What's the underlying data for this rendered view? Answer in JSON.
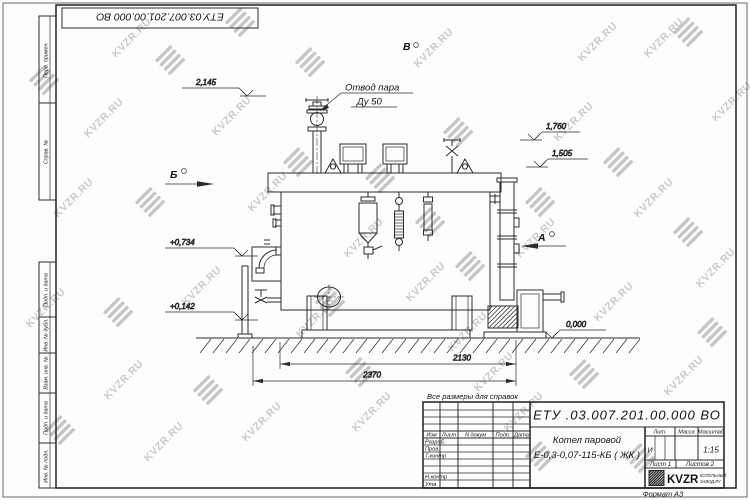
{
  "stamp_top": {
    "doc_number": "ЕТУ.03.007.201.00.000  ВО"
  },
  "watermark": {
    "label": "KVZR.RU"
  },
  "frame_columns": {
    "perv_primen": "Перв. примен.",
    "sprav_no": "Справ. №",
    "podp_data_1": "Подп. и дата",
    "inv_no_dubl": "Инв. № дубл.",
    "vzam_inv_no": "Взам. инв. №",
    "podp_data_2": "Подп. и дата",
    "inv_no_podl": "Инв. № подл."
  },
  "annotations": {
    "steam_line1": "Отвод пара",
    "steam_line2": "Ду 50",
    "note": "Все размеры для справок",
    "view_b": "Б",
    "view_v": "В",
    "view_a": "А"
  },
  "elevations": {
    "top_left": "2,145",
    "right_1": "1,760",
    "right_2": "1,505",
    "mid_left": "+0,734",
    "low_left": "+0,142",
    "ground": "0,000"
  },
  "dimensions": {
    "inner": "2130",
    "outer": "2370"
  },
  "title_block": {
    "doc_number": "ЕТУ .03.007.201.00.000  ВО",
    "product_line1": "Котел паровой",
    "product_line2": "Е-0,3-0,07-115-КБ ( ЖК )",
    "headers": {
      "izm": "Изм",
      "list": "Лист",
      "n_dokum": "N докум",
      "podp": "Подп.",
      "data": "Дата",
      "lit": "Лит.",
      "massa": "Масса",
      "masshtab": "Масштаб"
    },
    "rows": {
      "razrab": "Разраб.",
      "prov": "Пров.",
      "t_kontr": "Т.контр",
      "n_kontr": "Н.контр",
      "utv": "Утв."
    },
    "lit_value": "И",
    "scale": "1:15",
    "sheet": "Лист 1",
    "sheets": "Листов 2",
    "logo_text": "KVZR",
    "logo_sub1": "КОТЕЛЬНЫЙ",
    "logo_sub2": "ЗАВОД.РУ",
    "format": "Формат А3"
  },
  "colors": {
    "line": "#2b2b2b",
    "watermark": "#c8c8c8"
  }
}
